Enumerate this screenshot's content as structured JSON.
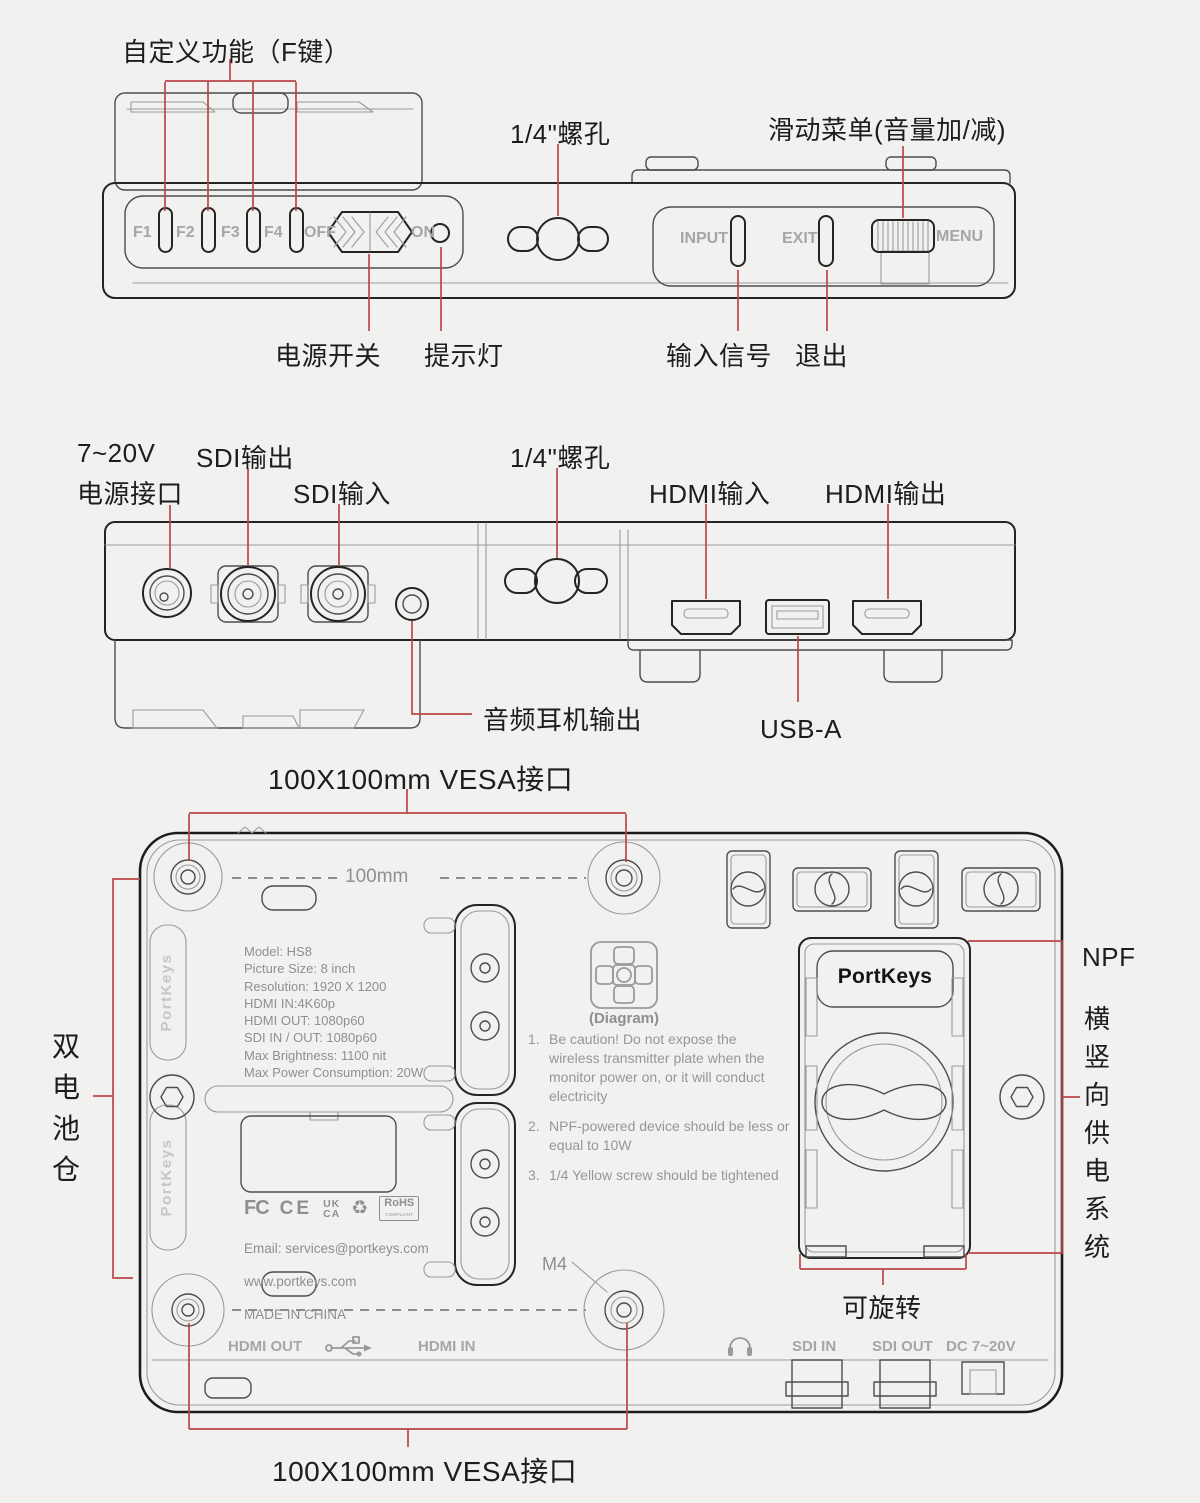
{
  "colors": {
    "background": "#f1f1f0",
    "line": "#242424",
    "red": "#bb4649",
    "gray_text": "#8f8f8f"
  },
  "top_view": {
    "labels": {
      "custom_fn": "自定义功能（F键）",
      "screw": "1/4\"螺孔",
      "slide_menu": "滑动菜单(音量加/减)",
      "power_switch": "电源开关",
      "indicator_light": "提示灯",
      "input_signal": "输入信号",
      "exit": "退出"
    },
    "buttons": {
      "f1": "F1",
      "f2": "F2",
      "f3": "F3",
      "f4": "F4",
      "off": "OFF",
      "on": "ON",
      "input": "INPUT",
      "exit": "EXIT",
      "menu": "MENU"
    }
  },
  "middle_view": {
    "labels": {
      "power_v": "7~20V",
      "power_port": "电源接口",
      "sdi_out": "SDI输出",
      "sdi_in": "SDI输入",
      "screw": "1/4\"螺孔",
      "hdmi_in": "HDMI输入",
      "hdmi_out": "HDMI输出",
      "headphone_out": "音频耳机输出",
      "usb": "USB-A"
    }
  },
  "back_view": {
    "labels": {
      "vesa_top": "100X100mm VESA接口",
      "vesa_bottom": "100X100mm VESA接口",
      "dim": "100mm",
      "battery_bays": "双电池仓",
      "npf_en": "NPF",
      "npf_cn": "横竖向供电系统",
      "rotatable": "可旋转",
      "m4": "M4"
    },
    "specs": [
      "Model: HS8",
      "Picture Size: 8 inch",
      "Resolution: 1920 X 1200",
      "HDMI IN:4K60p",
      "HDMI OUT: 1080p60",
      "SDI IN / OUT: 1080p60",
      "Max Brightness: 1100 nit",
      "Max Power Consumption: 20W"
    ],
    "diagram_caption": "(Diagram)",
    "notes": [
      {
        "num": "1.",
        "text": "Be caution! Do not expose the wireless transmitter plate when the monitor power on, or it will conduct electricity"
      },
      {
        "num": "2.",
        "text": "NPF-powered device should be less or equal to 10W"
      },
      {
        "num": "3.",
        "text": "1/4 Yellow screw should be tightened"
      }
    ],
    "certs": {
      "fcc": "FC",
      "ce": "CE",
      "ukca_top": "UK",
      "ukca_bottom": "CA",
      "recycle": "♻",
      "rohs": "RoHS",
      "rohs_sub": "COMPLIANT"
    },
    "contact": [
      "Email: services@portkeys.com",
      "www.portkeys.com",
      "MADE IN CHINA"
    ],
    "brand": "PortKeys",
    "ports": {
      "hdmi_out": "HDMI OUT",
      "hdmi_in": "HDMI IN",
      "sdi_in": "SDI IN",
      "sdi_out": "SDI OUT",
      "dc": "DC 7~20V"
    }
  }
}
